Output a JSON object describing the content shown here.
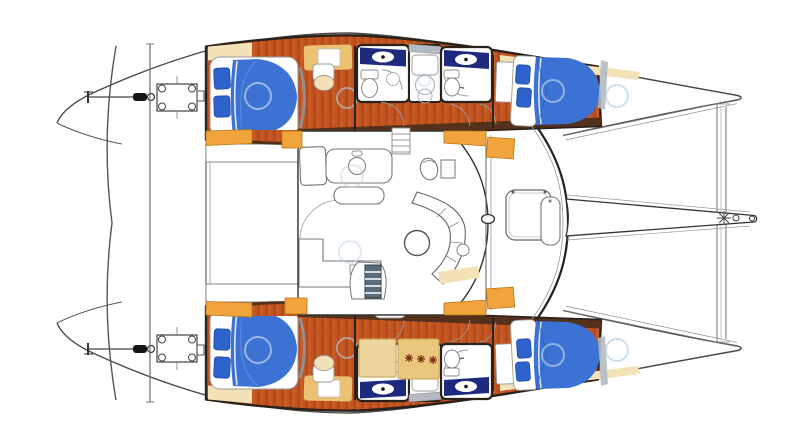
{
  "meta": {
    "title": "Catamaran interior layout plan",
    "type": "boat-floorplan",
    "view": "top-down",
    "orientation": "bow-right",
    "width_px": 800,
    "height_px": 446
  },
  "colors": {
    "canvas": "#ffffff",
    "outline": "#2a211a",
    "hull_line": "#4a4a4a",
    "line": "#777777",
    "wood_base": "#c2531f",
    "wood_streak_dark": "#9c3d12",
    "wood_streak_light": "#d9713a",
    "orange_cabinet": "#f1a43c",
    "orange_edge": "#b87818",
    "tan": "#eac271",
    "cream": "#f3e2b8",
    "cream_edge": "#c9a96a",
    "bed_blue": "#3b72d4",
    "bed_blue_dark": "#2458b8",
    "bed_blue_light": "#6fa0e8",
    "pillow_blue": "#2e63cc",
    "navy_floor": "#1d2a7d",
    "partition_gray": "#b3bac1",
    "shadow_gray": "#8d959c",
    "hatch_ring_blue": "#b7cfe6",
    "brown_band": "#55301a",
    "steps_slate": "#5a6b7a",
    "stove_tan": "#e9c87e",
    "stove_tan_light": "#edd49a",
    "stove_mark": "#7a2c10",
    "hardware_black": "#151515"
  },
  "inventory": {
    "hulls": 2,
    "cabins": 4,
    "double_berths": 4,
    "heads": 4,
    "shower_stalls": 2,
    "cockpit_benches": 2,
    "salon": "galley + curved dinette settee with round table",
    "foredeck": "trampoline with central bowsprit and forward crossbeam"
  }
}
